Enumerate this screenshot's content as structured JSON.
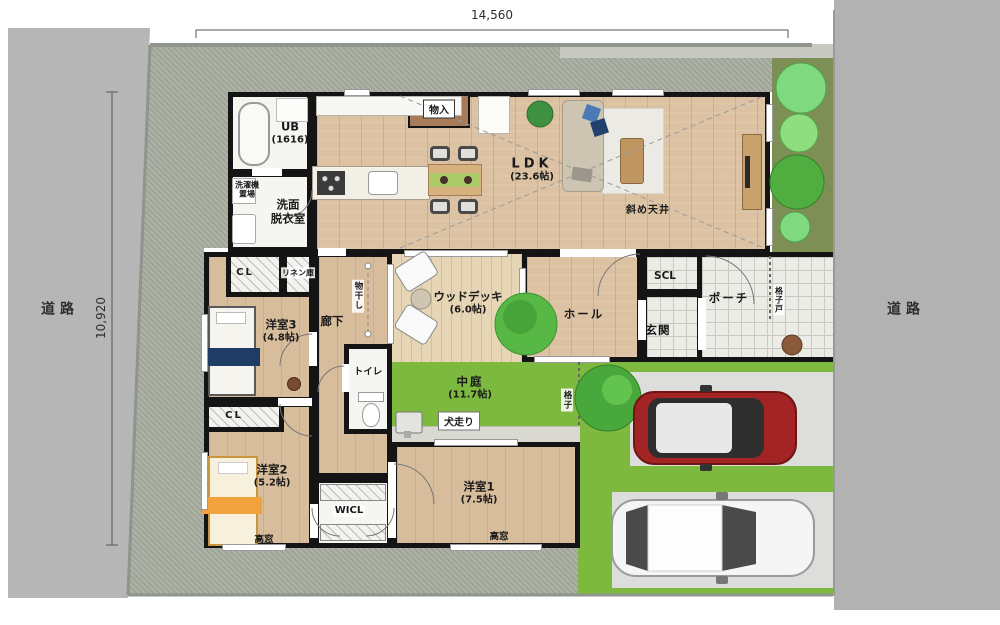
{
  "site": {
    "dimension_width": "14,560",
    "dimension_height": "10,920",
    "road_left": "道路",
    "road_right": "道路"
  },
  "labels": {
    "ub_name": "UB",
    "ub_size": "(1616)",
    "laundry_line1": "洗濯機",
    "laundry_line2": "置場",
    "washroom_line1": "洗面",
    "washroom_line2": "脱衣室",
    "storage": "物入",
    "ldk_name": "LDK",
    "ldk_size": "(23.6帖)",
    "slanted_ceiling": "斜め天井",
    "cl_top": "CL",
    "linen_closet": "リネン庫",
    "bedroom3_name": "洋室3",
    "bedroom3_size": "(4.8帖)",
    "corridor": "廊下",
    "clothes_drying": "物干し",
    "toilet": "トイレ",
    "wood_deck_name": "ウッドデッキ",
    "wood_deck_size": "(6.0帖)",
    "hall": "ホール",
    "shoe_closet": "SCL",
    "entrance": "玄関",
    "porch": "ポーチ",
    "lattice_door": "格子戸",
    "courtyard_name": "中庭",
    "courtyard_size": "(11.7帖)",
    "lattice_fence": "格子",
    "dog_run": "犬走り",
    "bedroom1_name": "洋室1",
    "bedroom1_size": "(7.5帖)",
    "high_window_1": "高窓",
    "cl_bottom": "CL",
    "bedroom2_name": "洋室2",
    "bedroom2_size": "(5.2帖)",
    "wicl": "WICL",
    "high_window_2": "高窓"
  },
  "colors": {
    "wall": "#141414",
    "wood_floor": "#dcc2a2",
    "deck": "#ead9bd",
    "tile": "#ecece7",
    "grass": "#7cb93e",
    "gravel": "#a7ad9f",
    "road": "#b6b6b6",
    "bed_navy": "#1e3c64",
    "bed_orange": "#f2a23c",
    "car_red": "#a32424",
    "car_white": "#f5f5f5",
    "tree_green": "#4fae3f"
  }
}
